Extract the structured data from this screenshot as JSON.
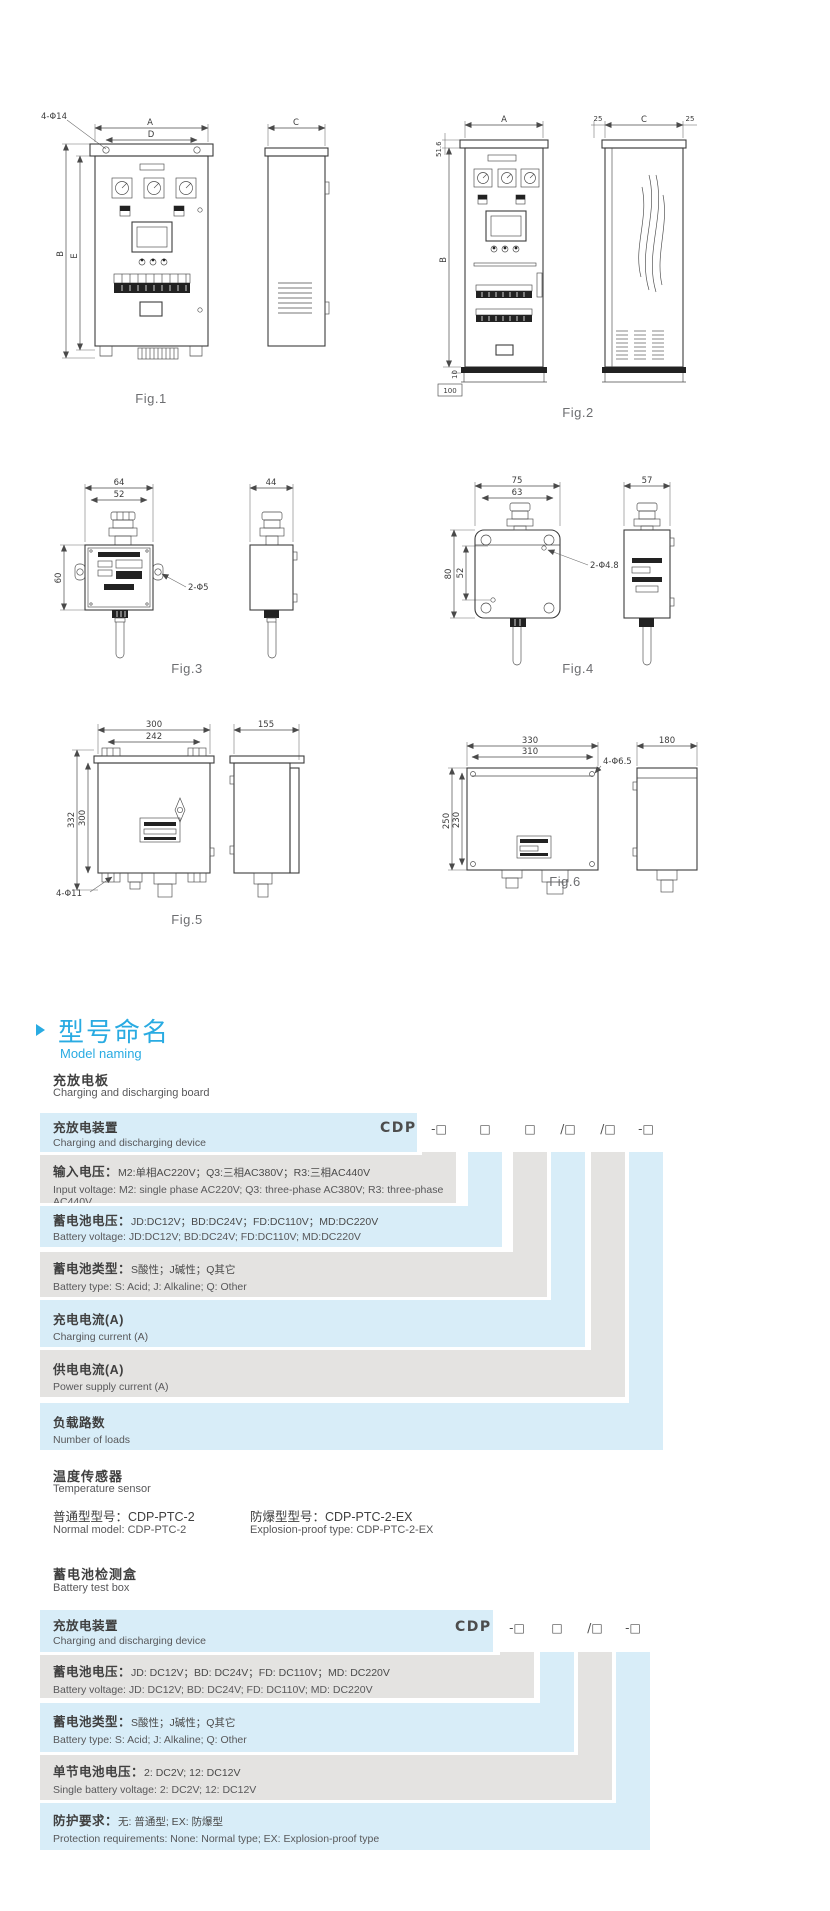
{
  "colors": {
    "accent_blue": "#29abe2",
    "row_blue": "#d8edf8",
    "row_gray": "#e4e3e1"
  },
  "figs": {
    "fig1": {
      "caption": "Fig.1",
      "dim_a": "A",
      "dim_d": "D",
      "dim_b": "B",
      "dim_e": "E",
      "dim_c": "C",
      "holes": "4-Φ14"
    },
    "fig2": {
      "caption": "Fig.2",
      "dim_a": "A",
      "dim_b": "B",
      "dim_c": "C",
      "dim_top": "51.6",
      "dim_25l": "25",
      "dim_25r": "25",
      "dim_10": "10",
      "dim_100": "100"
    },
    "fig3": {
      "caption": "Fig.3",
      "dim_w": "64",
      "dim_wi": "52",
      "dim_h": "60",
      "dim_side": "44",
      "holes": "2-Φ5"
    },
    "fig4": {
      "caption": "Fig.4",
      "dim_w": "75",
      "dim_wi": "63",
      "dim_h": "80",
      "dim_hi": "52",
      "dim_side": "57",
      "holes": "2-Φ4.8"
    },
    "fig5": {
      "caption": "Fig.5",
      "dim_w": "300",
      "dim_wi": "242",
      "dim_h": "332",
      "dim_hi": "300",
      "dim_side": "155",
      "holes": "4-Φ11"
    },
    "fig6": {
      "caption": "Fig.6",
      "dim_w": "330",
      "dim_wi": "310",
      "dim_h": "250",
      "dim_hi": "230",
      "dim_side": "180",
      "holes": "4-Φ6.5"
    }
  },
  "section": {
    "title_cn": "型号命名",
    "title_en": "Model naming"
  },
  "board": {
    "heading_cn": "充放电板",
    "heading_en": "Charging and discharging board",
    "code_prefix": "CDP",
    "symbols": [
      "-□",
      "□",
      "□",
      "/□",
      "/□",
      "-□"
    ],
    "rows": [
      {
        "cn": "充放电装置",
        "en": "Charging and discharging device"
      },
      {
        "label": "输入电压：",
        "detail": "M2:单相AC220V；Q3:三相AC380V；R3:三相AC440V",
        "en": "Input voltage: M2: single phase AC220V; Q3: three-phase AC380V; R3: three-phase AC440V"
      },
      {
        "label": "蓄电池电压：",
        "detail": "JD:DC12V；BD:DC24V；FD:DC110V；MD:DC220V",
        "en": "Battery voltage: JD:DC12V; BD:DC24V; FD:DC110V; MD:DC220V"
      },
      {
        "label": "蓄电池类型：",
        "detail": "S酸性；J碱性；Q其它",
        "en": "Battery type: S: Acid; J: Alkaline; Q: Other"
      },
      {
        "cn": "充电电流(A)",
        "en": "Charging current (A)"
      },
      {
        "cn": "供电电流(A)",
        "en": "Power supply current (A)"
      },
      {
        "cn": "负载路数",
        "en": "Number of loads"
      }
    ]
  },
  "sensor": {
    "heading_cn": "温度传感器",
    "heading_en": "Temperature sensor",
    "normal_cn": "普通型型号：CDP-PTC-2",
    "ex_cn": "防爆型型号：CDP-PTC-2-EX",
    "normal_en": "Normal model: CDP-PTC-2",
    "ex_en": "Explosion-proof type: CDP-PTC-2-EX"
  },
  "testbox": {
    "heading_cn": "蓄电池检测盒",
    "heading_en": "Battery test box",
    "code_prefix": "CDP",
    "symbols": [
      "-□",
      "□",
      "/□",
      "-□"
    ],
    "rows": [
      {
        "cn": "充放电装置",
        "en": "Charging and discharging device"
      },
      {
        "label": "蓄电池电压：",
        "detail": "JD: DC12V；BD: DC24V；FD: DC110V；MD: DC220V",
        "en": "Battery voltage: JD: DC12V; BD: DC24V; FD: DC110V; MD: DC220V"
      },
      {
        "label": "蓄电池类型：",
        "detail": "S酸性；J碱性；Q其它",
        "en": "Battery type: S: Acid; J: Alkaline; Q: Other"
      },
      {
        "label": "单节电池电压：",
        "detail": "2: DC2V; 12: DC12V",
        "en": "Single battery voltage:  2: DC2V; 12: DC12V"
      },
      {
        "label": "防护要求：",
        "detail": "无: 普通型; EX: 防爆型",
        "en": "Protection requirements:  None: Normal type; EX: Explosion-proof type"
      }
    ]
  }
}
